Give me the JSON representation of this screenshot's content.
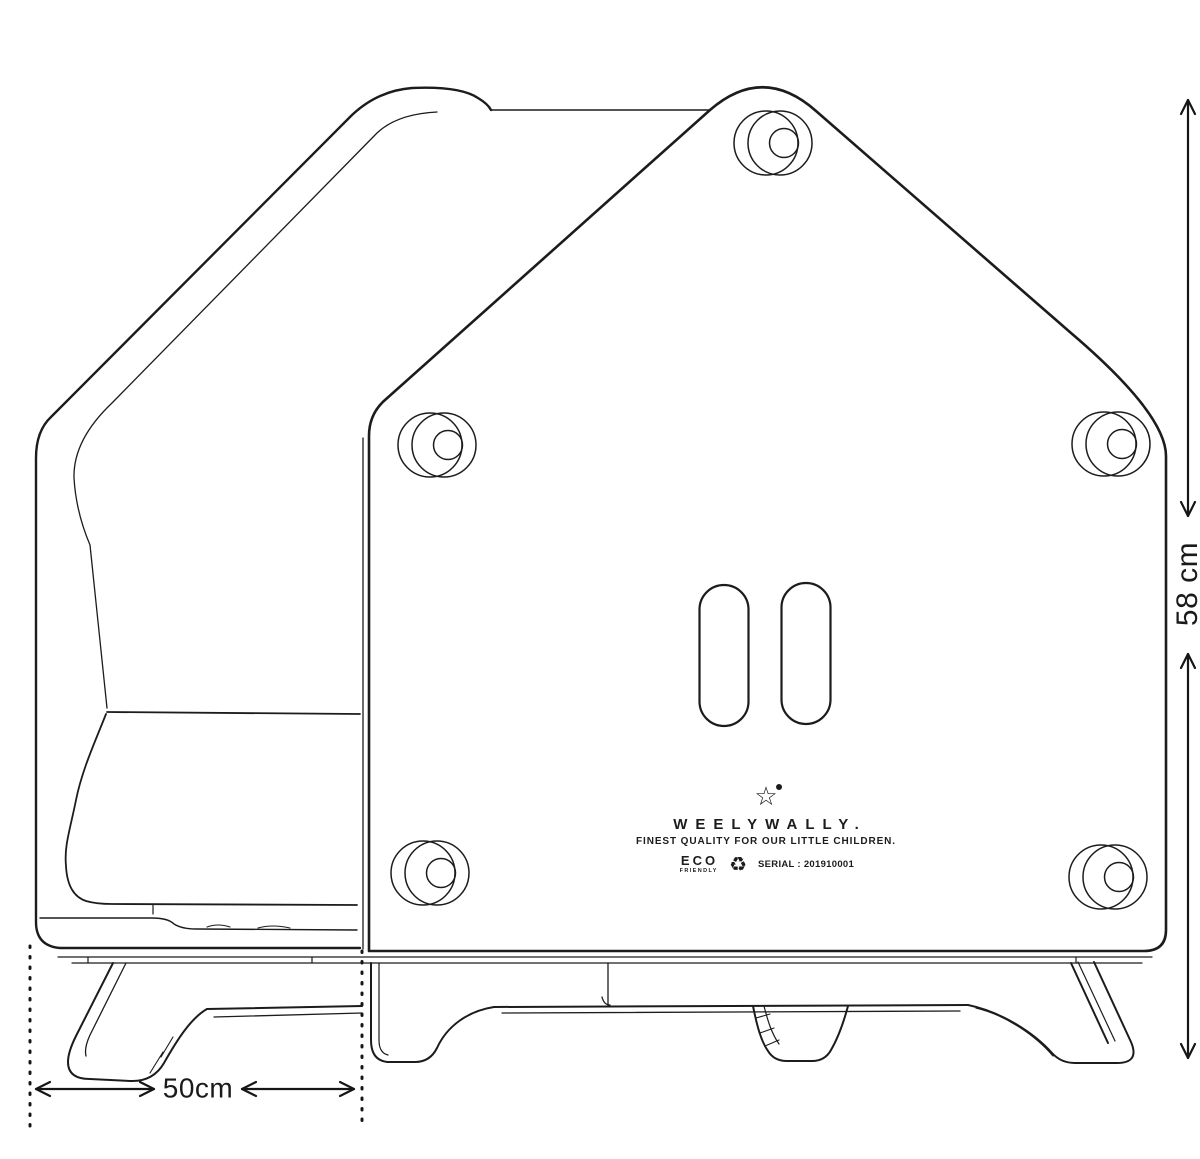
{
  "page": {
    "background": "#ffffff",
    "ink": "#1c1c1c"
  },
  "drawing": {
    "subject": "house-shaped children's furniture, rear elevation line drawing",
    "branding": {
      "star_icon": "star-with-dot",
      "name": "WEELYWALLY.",
      "tagline": "FINEST QUALITY FOR OUR LITTLE CHILDREN.",
      "eco_line1": "ECO",
      "eco_line2": "FRIENDLY",
      "recycle_icon": "recycling-arrows",
      "serial": "SERIAL : 201910001"
    },
    "dimensions": {
      "height": "58 cm",
      "width": "50cm"
    }
  }
}
